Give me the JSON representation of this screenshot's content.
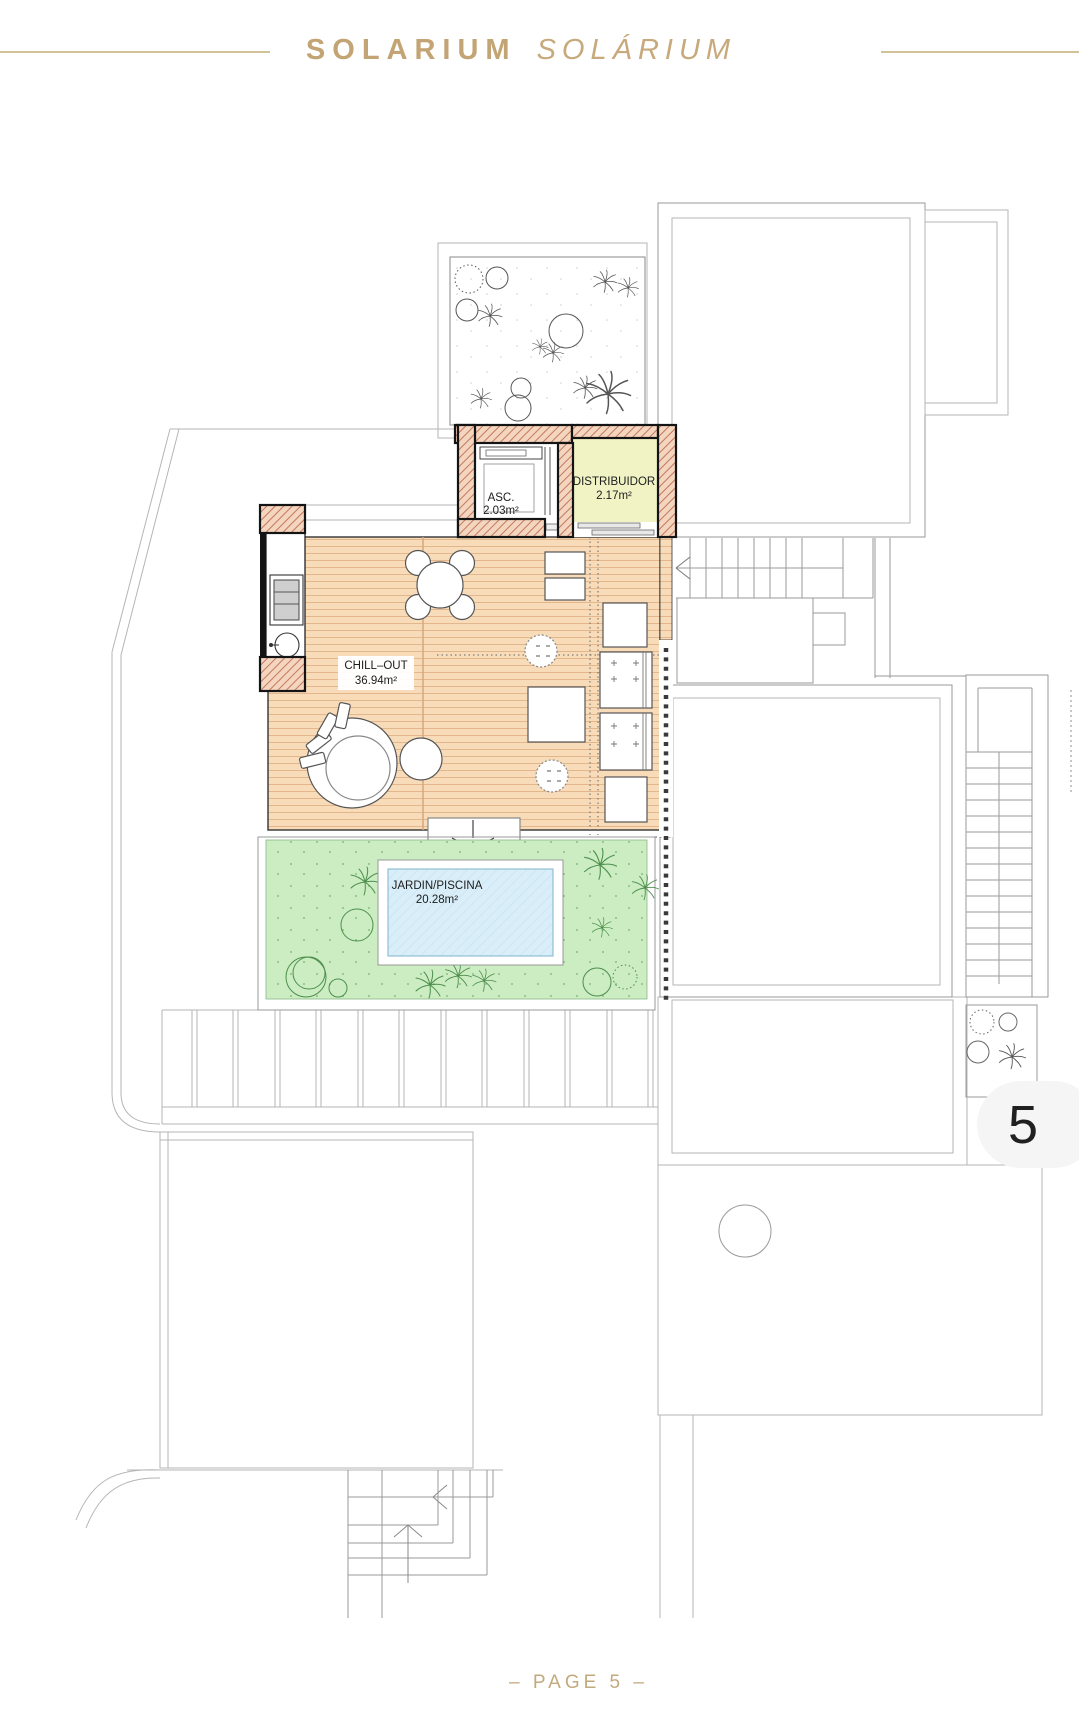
{
  "header": {
    "title_primary": "SOLARIUM",
    "title_secondary": "SOLÁRIUM"
  },
  "footer": {
    "page_label": "– PAGE 5 –"
  },
  "unit_badge": {
    "number": "5"
  },
  "plan": {
    "rooms": [
      {
        "name": "ASC.",
        "area": "2.03m²"
      },
      {
        "name": "DISTRIBUIDOR",
        "area": "2.17m²"
      },
      {
        "name": "CHILL–OUT",
        "area": "36.94m²"
      },
      {
        "name": "JARDIN/PISCINA",
        "area": "20.28m²"
      }
    ],
    "colors": {
      "accent_gold": "#C3A474",
      "wall_fill": "#F3D5C0",
      "wall_hatch": "#C4785A",
      "deck": "#F8DCBA",
      "deck_line": "#E3B68B",
      "distributor_floor": "#F1F3C5",
      "garden": "#CBEDC1",
      "garden_plant": "#4E8E4E",
      "pool_water": "#D9EEF8",
      "badge_bg": "#F5F5F5",
      "outline_faint": "#B5B5B5"
    }
  }
}
